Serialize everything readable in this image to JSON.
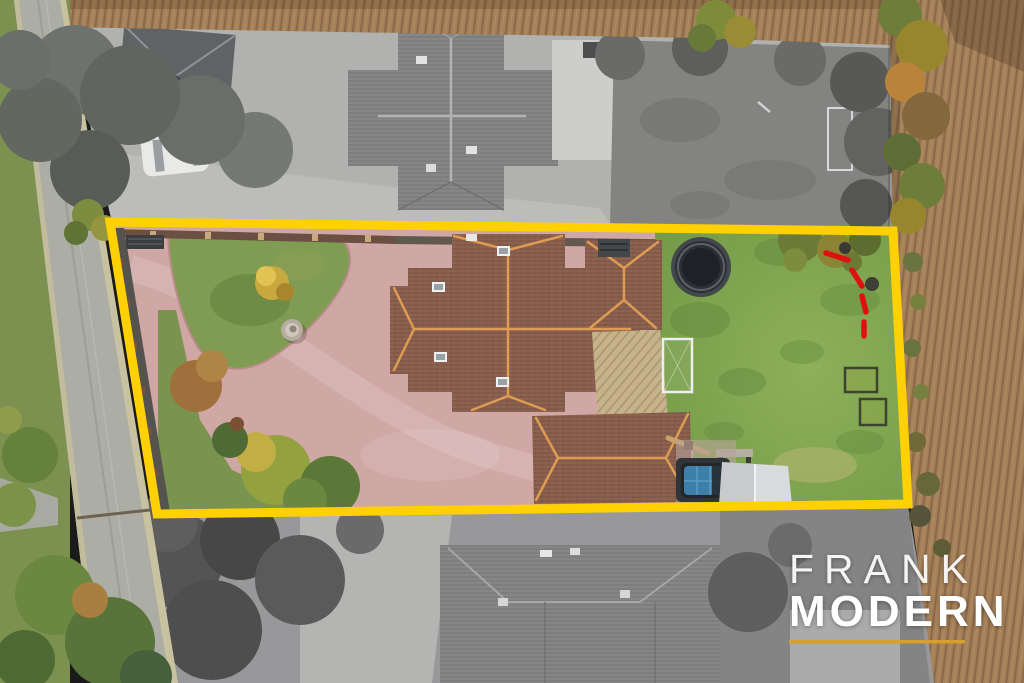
{
  "scene": {
    "kind": "aerial-drone-photo",
    "features": [
      "road",
      "front-driveway",
      "front-lawn-island",
      "fountain",
      "yellow-shrub",
      "main-house-roof",
      "west-wing-roof",
      "east-wing-roof",
      "rear-annex-roof",
      "decking",
      "rear-lawn",
      "trampoline",
      "football-goal",
      "garden-frames",
      "hot-tub",
      "gazebo",
      "garden-bench",
      "seesaw",
      "red-dashed-marks",
      "ploughed-field-top",
      "ploughed-field-right",
      "hedgerow",
      "neighbour-plot-north",
      "neighbour-plot-south",
      "white-car"
    ]
  },
  "logo": {
    "line1": "FRANK",
    "line2": "MODERN"
  },
  "colors": {
    "boundary_line": "#FFD103",
    "red_dashes": "#E01010",
    "logo_text": "#FFFFFF",
    "logo_underline": "#D79F2E"
  }
}
